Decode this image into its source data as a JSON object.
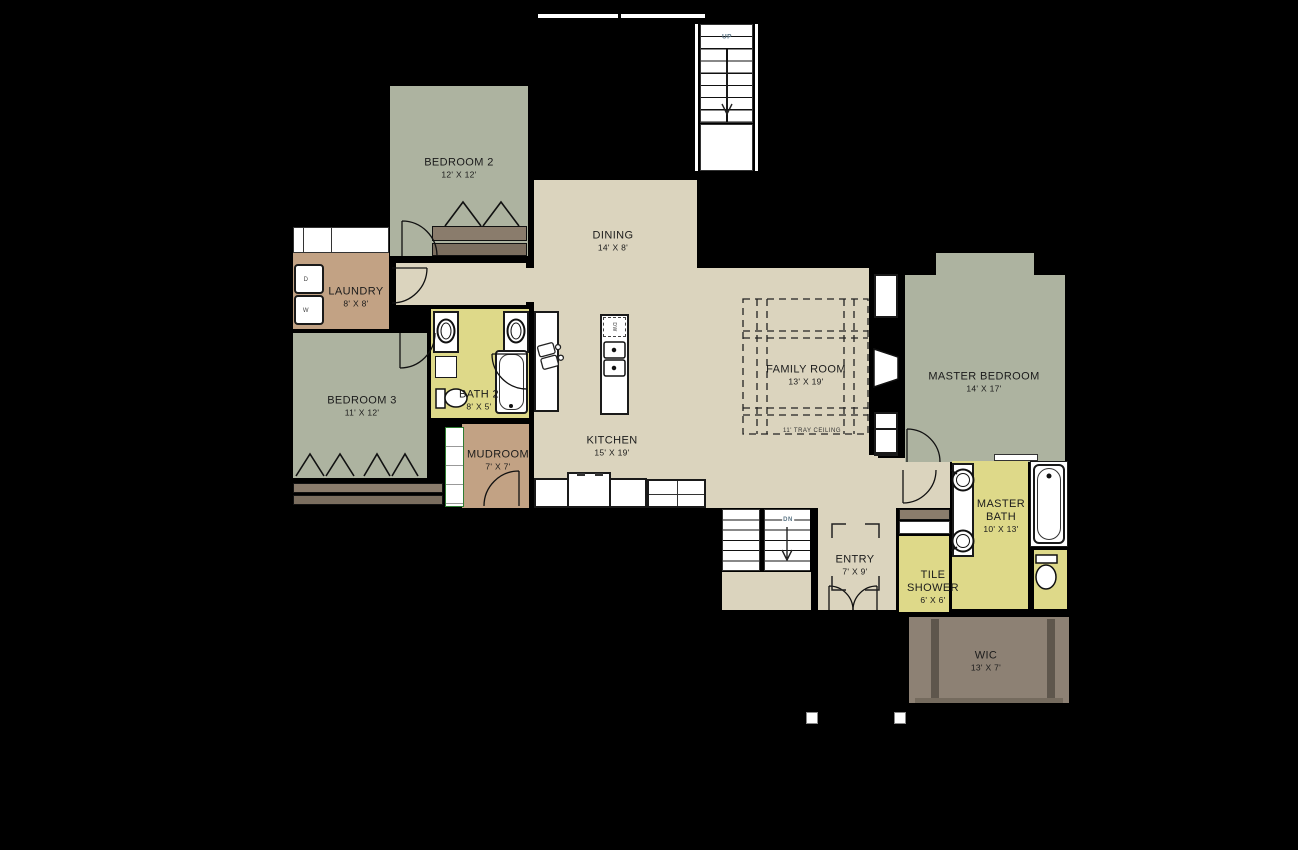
{
  "title": "First floor plan",
  "colors": {
    "sage": "#adb3a0",
    "beige": "#dbd4be",
    "yellow": "#ded989",
    "tan": "#c2a284",
    "taupe": "#8d8174",
    "shelf": "#8a7c6c",
    "shelf2": "#7b6e5f",
    "dark": "#5e564c",
    "ink": "#1b1b1b",
    "bg": "#000000"
  },
  "rooms": [
    {
      "key": "bedroom2",
      "name": "BEDROOM 2",
      "dims": "12' X 12'"
    },
    {
      "key": "dining",
      "name": "DINING",
      "dims": "14' X 8'"
    },
    {
      "key": "laundry",
      "name": "LAUNDRY",
      "dims": "8' X 8'"
    },
    {
      "key": "bedroom3",
      "name": "BEDROOM 3",
      "dims": "11' X 12'"
    },
    {
      "key": "bath2",
      "name": "BATH 2",
      "dims": "8' X 5'"
    },
    {
      "key": "mudroom",
      "name": "MUDROOM",
      "dims": "7' X 7'"
    },
    {
      "key": "kitchen",
      "name": "KITCHEN",
      "dims": "15' X 19'"
    },
    {
      "key": "family_room",
      "name": "FAMILY ROOM",
      "dims": "13' X 19'"
    },
    {
      "key": "master_bedroom",
      "name": "MASTER BEDROOM",
      "dims": "14' X 17'"
    },
    {
      "key": "master_bath",
      "name": "MASTER BATH",
      "dims": "10' X 13'"
    },
    {
      "key": "tile_shower",
      "name": "TILE SHOWER",
      "dims": "6' X 6'"
    },
    {
      "key": "entry",
      "name": "ENTRY",
      "dims": "7' X 9'"
    },
    {
      "key": "wic",
      "name": "WIC",
      "dims": "13' X 7'"
    }
  ],
  "annotations": {
    "tray_ceiling": "11' TRAY CEILING",
    "stairs_up": "UP",
    "stairs_down": "DN",
    "dryer": "D",
    "washer": "W",
    "dishwasher": "DW"
  }
}
